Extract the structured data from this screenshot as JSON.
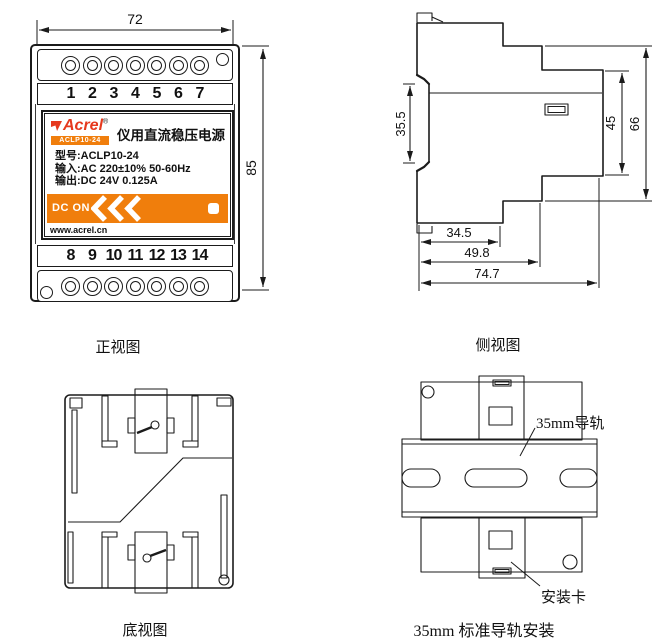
{
  "colors": {
    "accent_orange": "#f07e0c",
    "brand_red": "#e6391e",
    "line": "#1b1b1b"
  },
  "front_view": {
    "caption": "正视图",
    "dim_width": "72",
    "dim_height": "85",
    "terminals_top": [
      "1",
      "2",
      "3",
      "4",
      "5",
      "6",
      "7"
    ],
    "terminals_bottom": [
      "8",
      "9",
      "10",
      "11",
      "12",
      "13",
      "14"
    ],
    "label": {
      "brand": "Acrel",
      "reg": "®",
      "model_badge": "ACLP10-24",
      "title": "仪用直流稳压电源",
      "spec_model": "型号:ACLP10-24",
      "spec_input": "输入:AC 220±10% 50-60Hz",
      "spec_output": "输出:DC 24V 0.125A",
      "dc_on": "DC ON",
      "website": "www.acrel.cn"
    }
  },
  "side_view": {
    "caption": "侧视图",
    "dims": {
      "groove": "35.5",
      "inner_height": "45",
      "outer_height": "66",
      "depth1": "34.5",
      "depth2": "49.8",
      "depth3": "74.7"
    }
  },
  "bottom_view": {
    "caption": "底视图"
  },
  "rail_view": {
    "caption": "35mm 标准导轨安装",
    "rail_label": "35mm导轨",
    "clip_label": "安装卡"
  }
}
